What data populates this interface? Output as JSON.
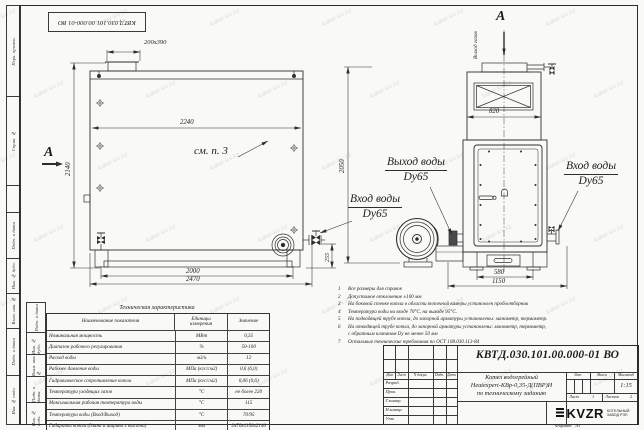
{
  "watermark": {
    "text": "kotel-kv.kz"
  },
  "stamp_top": "КВТД.030.101.00.000-01 ВО",
  "margin_labels": [
    "Перв. примен.",
    "Справ. №",
    "Подп. и дата",
    "Инв. № дубл.",
    "Взам. инв. №",
    "Подп. и дата",
    "Инв. № подл."
  ],
  "inner_margin_labels": [
    "Подп. и дата",
    "Инв. № дубл.",
    "Взам. инв. №",
    "Подп. и дата",
    "Инв. № подл."
  ],
  "drawing": {
    "section_label_left": "А",
    "section_label_top": "А",
    "gas_outlet_label": "Выход газов",
    "see_note": "см. п. 3",
    "water_out_line1": "Выход воды",
    "water_out_line2": "Dy65",
    "water_in_left_line1": "Вход воды",
    "water_in_left_line2": "Dy65",
    "water_in_right_line1": "Вход воды",
    "water_in_right_line2": "Dy65",
    "dims": {
      "chimney": "200x390",
      "body_width": "2240",
      "side_height": "2140",
      "front_height": "2050",
      "pipe_height": "255",
      "legs_span": "2000",
      "total_length": "2470",
      "top_width": "820",
      "base_span": "580",
      "total_width": "1150"
    }
  },
  "notes": [
    {
      "num": "1",
      "text": "Все размеры для справок"
    },
    {
      "num": "2",
      "text": "Допустимое отклонение ±100 мм"
    },
    {
      "num": "3",
      "text": "На боковой стенке котла в области топочной камеры установлен пробоотборник"
    },
    {
      "num": "4",
      "text": "Температура воды на входе 70°С, на выходе 95°С."
    },
    {
      "num": "5",
      "text": "На подводящей трубе котла, до запорной арматуры установлены: манометр, термометр."
    },
    {
      "num": "6",
      "text": "На отводящей трубе котла, до запорной арматуры установлены: манометр, термометр,"
    },
    {
      "num": "",
      "text": "с обратным клапаном Dу не менее 50 мм"
    },
    {
      "num": "7",
      "text": "Остальные технические требования по ОСТ 108.030.113-84"
    }
  ],
  "tech_table": {
    "title": "Техническая характеристика",
    "col_name": "Наименование показателя",
    "col_units_1": "Единицы",
    "col_units_2": "измерения",
    "col_value": "Значение",
    "rows": [
      {
        "name": "Номинальная мощность",
        "units": "МВт",
        "value": "0,35"
      },
      {
        "name": "Диапазон рабочего регулирования",
        "units": "%",
        "value": "50-100"
      },
      {
        "name": "Расход воды",
        "units": "м3/ч",
        "value": "12"
      },
      {
        "name": "Рабочее давление воды",
        "units": "МПа (кгс/см2)",
        "value": "0,6 (6,0)"
      },
      {
        "name": "Гидравлическое сопротивление котла",
        "units": "МПа (кгс/см2)",
        "value": "0,06 (0,6)"
      },
      {
        "name": "Температура уходящих газов",
        "units": "°С",
        "value": "не более 220"
      },
      {
        "name": "Максимальная рабочая температура воды",
        "units": "°С",
        "value": "115"
      },
      {
        "name": "Температура воды (Вход/Выход)",
        "units": "°С",
        "value": "70/95"
      },
      {
        "name": "Габариты котла (длина и ширина х высота)",
        "units": "мм",
        "value": "2470х1150х2140"
      }
    ]
  },
  "title_block": {
    "doc_number": "КВТД.030.101.00.000-01  ВО",
    "product_line1": "Котел водогрейный",
    "product_line2": "Heatexpert-КВр-0,35-Д(ПВР)И",
    "product_line3": "по техническому заданию",
    "col_izm": "Изм",
    "col_list": "Лист",
    "col_ndoc": "N докум.",
    "col_podp": "Подп.",
    "col_data": "Дата",
    "roles": [
      "Разраб.",
      "Пров.",
      "Т.контр.",
      "Н.контр.",
      "Утв."
    ],
    "lit_label": "Лит.",
    "mass_label": "Масса",
    "scale_label": "Масштаб",
    "scale_value": "1:15",
    "sheet_label": "Лист",
    "sheet_value": "1",
    "sheets_label": "Листов",
    "sheets_value": "2",
    "logo_text": "KVZR",
    "logo_caption1": "КОТЕЛЬНЫЙ",
    "logo_caption2": "ЗАВОД РЭП",
    "format_label": "Формат",
    "format_value": "А3"
  }
}
